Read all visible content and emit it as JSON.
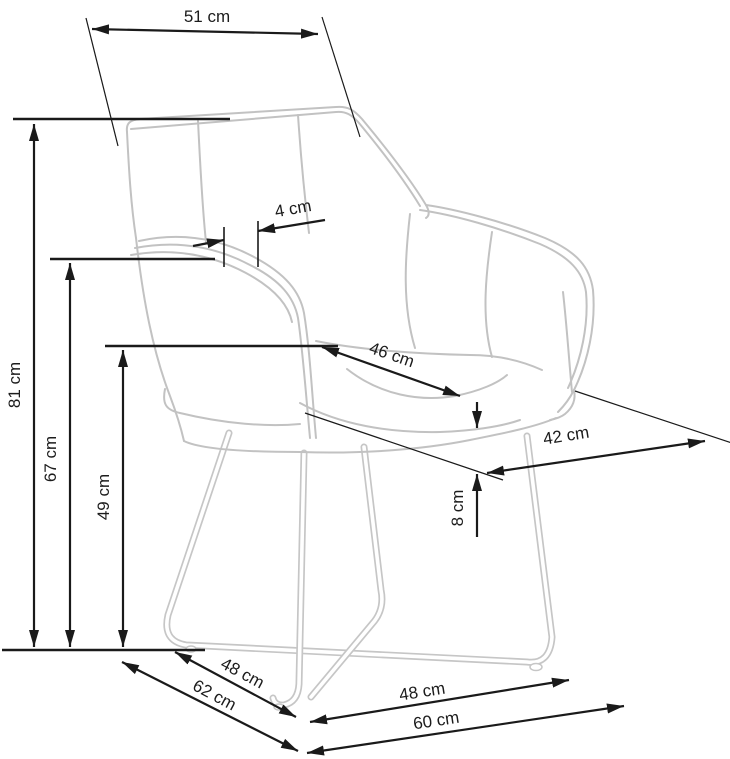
{
  "diagram": {
    "type": "furniture-dimension-drawing",
    "subject": "upholstered armchair with metal sled base",
    "unit": "cm",
    "dimensions": [
      {
        "id": "overall-width-top",
        "label": "51 cm",
        "value": 51
      },
      {
        "id": "overall-height",
        "label": "81 cm",
        "value": 81
      },
      {
        "id": "armrest-height",
        "label": "67 cm",
        "value": 67
      },
      {
        "id": "seat-height",
        "label": "49 cm",
        "value": 49
      },
      {
        "id": "armrest-thickness",
        "label": "4 cm",
        "value": 4
      },
      {
        "id": "seat-width",
        "label": "46 cm",
        "value": 46
      },
      {
        "id": "seat-depth",
        "label": "42 cm",
        "value": 42
      },
      {
        "id": "cushion-thickness",
        "label": "8 cm",
        "value": 8
      },
      {
        "id": "base-depth-inner",
        "label": "48 cm",
        "value": 48
      },
      {
        "id": "base-depth-outer",
        "label": "62 cm",
        "value": 62
      },
      {
        "id": "base-width-inner",
        "label": "48 cm",
        "value": 48
      },
      {
        "id": "base-width-outer",
        "label": "60 cm",
        "value": 60
      }
    ],
    "colors": {
      "dimension_lines": "#1a1a1a",
      "chair_outline": "#c2c2c2",
      "background": "#ffffff"
    }
  }
}
